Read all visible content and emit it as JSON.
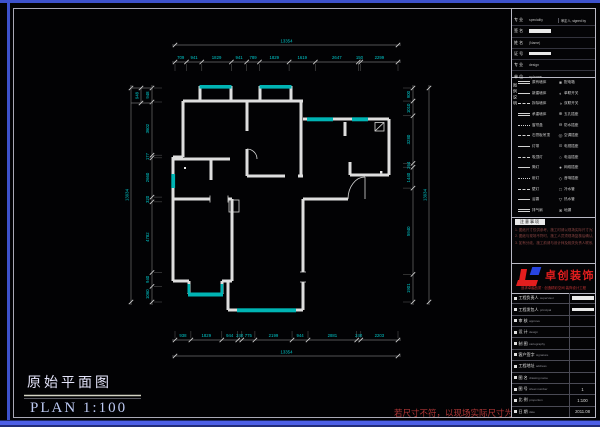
{
  "sheet": {
    "title_cn": "原始平面图",
    "title_en": "PLAN   1:100",
    "disclaimer": "若尺寸不符，以现场实际尺寸为准"
  },
  "colors": {
    "wall": "#dedede",
    "window_teal": "#00b4b4",
    "dim_text": "#00c8cb",
    "dim_line": "#6e6e6e",
    "tick": "#cccccc",
    "frame_blue": "#3d52cc",
    "frame_blue_bottom": "#4d5fe6",
    "logo_red": "#e31e1e",
    "logo_blue": "#2744e0",
    "disclaimer_red": "#b23737"
  },
  "dimensions": {
    "top": {
      "overall": "13354",
      "segments": [
        709,
        941,
        1829,
        941,
        789,
        1829,
        1619,
        2647,
        150,
        2299
      ]
    },
    "bottom": {
      "overall": "13354",
      "segments": [
        938,
        1829,
        944,
        240,
        775,
        2199,
        944,
        2881,
        240,
        2203
      ]
    },
    "left": {
      "overall": "13934",
      "segments": [
        948,
        3602,
        177,
        2660,
        320,
        4782,
        940,
        1060
      ]
    },
    "right": {
      "overall": "13934",
      "segments": [
        900,
        1010,
        3280,
        264,
        1440,
        5940,
        1901
      ]
    },
    "detail": "948"
  },
  "titleblock": {
    "info_rows": [
      {
        "label": "专 业",
        "value": "speciality",
        "right": "审定人, signed by",
        "blob": false
      },
      {
        "label": "签 名",
        "value": "",
        "right": "",
        "blob": true
      },
      {
        "label": "姓 名",
        "value": "(Name)",
        "right": "",
        "blob": false
      },
      {
        "label": "证 号",
        "value": "",
        "right": "",
        "blob": true
      },
      {
        "label": "专 业",
        "value": "design",
        "right": "",
        "blob": false
      },
      {
        "label": "单 位",
        "value": "xy home",
        "right": "",
        "blob": false
      }
    ],
    "legend_title": "图例说明",
    "legend_rows": [
      {
        "sample": "double",
        "name": "原有墙体",
        "symbol": "■",
        "name2": "配电箱"
      },
      {
        "sample": "solid",
        "name": "新建墙体",
        "symbol": "◐",
        "name2": "单联开关"
      },
      {
        "sample": "dashed",
        "name": "拆除墙体",
        "symbol": "◑",
        "name2": "双联开关"
      },
      {
        "sample": "double",
        "name": "承重墙体",
        "symbol": "⊕",
        "name2": "五孔插座"
      },
      {
        "sample": "dashdot",
        "name": "窗帘盒",
        "symbol": "⊖",
        "name2": "防水插座"
      },
      {
        "sample": "dashed",
        "name": "石膏板吊顶",
        "symbol": "◎",
        "name2": "空调插座"
      },
      {
        "sample": "solid",
        "name": "灯带",
        "symbol": "⊙",
        "name2": "电视插座"
      },
      {
        "sample": "dashed",
        "name": "吸顶灯",
        "symbol": "○",
        "name2": "电话插座"
      },
      {
        "sample": "solid",
        "name": "筒灯",
        "symbol": "●",
        "name2": "网络插座"
      },
      {
        "sample": "dashdot",
        "name": "射灯",
        "symbol": "◇",
        "name2": "音响插座"
      },
      {
        "sample": "dashed",
        "name": "壁灯",
        "symbol": "□",
        "name2": "冷水管"
      },
      {
        "sample": "solid",
        "name": "浴霸",
        "symbol": "▽",
        "name2": "热水管"
      },
      {
        "sample": "double",
        "name": "排气扇",
        "symbol": "⊗",
        "name2": "地漏"
      }
    ],
    "notes_header": "注意事项",
    "notes": [
      "1. 图纸尺寸仅供参考，施工时请以现场实际尺寸为准。",
      "2. 图纸与现场不符时，施工人员须现场复核后确认。",
      "3. 如有分歧，施工前请与设计师及相关负责人联系。"
    ],
    "logo": {
      "name": "卓创装饰",
      "tagline": "追求卓越品质 · 创造精彩空间 装饰设计工程"
    },
    "table_rows": [
      {
        "label": "工程负责人",
        "sub": "supervisor",
        "value": "",
        "blob": true
      },
      {
        "label": "工程发包人",
        "sub": "principal",
        "value": "",
        "blob": true
      },
      {
        "label": "审 核",
        "sub": "approve",
        "value": "",
        "blob": false
      },
      {
        "label": "设 计",
        "sub": "design",
        "value": "",
        "blob": false
      },
      {
        "label": "制 图",
        "sub": "cartography",
        "value": "",
        "blob": false
      },
      {
        "label": "客户签字",
        "sub": "signature",
        "value": "",
        "blob": false
      },
      {
        "label": "工程地址",
        "sub": "address",
        "value": "",
        "blob": false
      },
      {
        "label": "图 名",
        "sub": "drawing name",
        "value": "",
        "blob": false
      },
      {
        "label": "图 号",
        "sub": "sheet number",
        "value": "1",
        "blob": false
      },
      {
        "label": "比 例",
        "sub": "proportion",
        "value": "1:100",
        "blob": false
      },
      {
        "label": "日 期",
        "sub": "date",
        "value": "2011.08",
        "blob": false
      }
    ]
  }
}
